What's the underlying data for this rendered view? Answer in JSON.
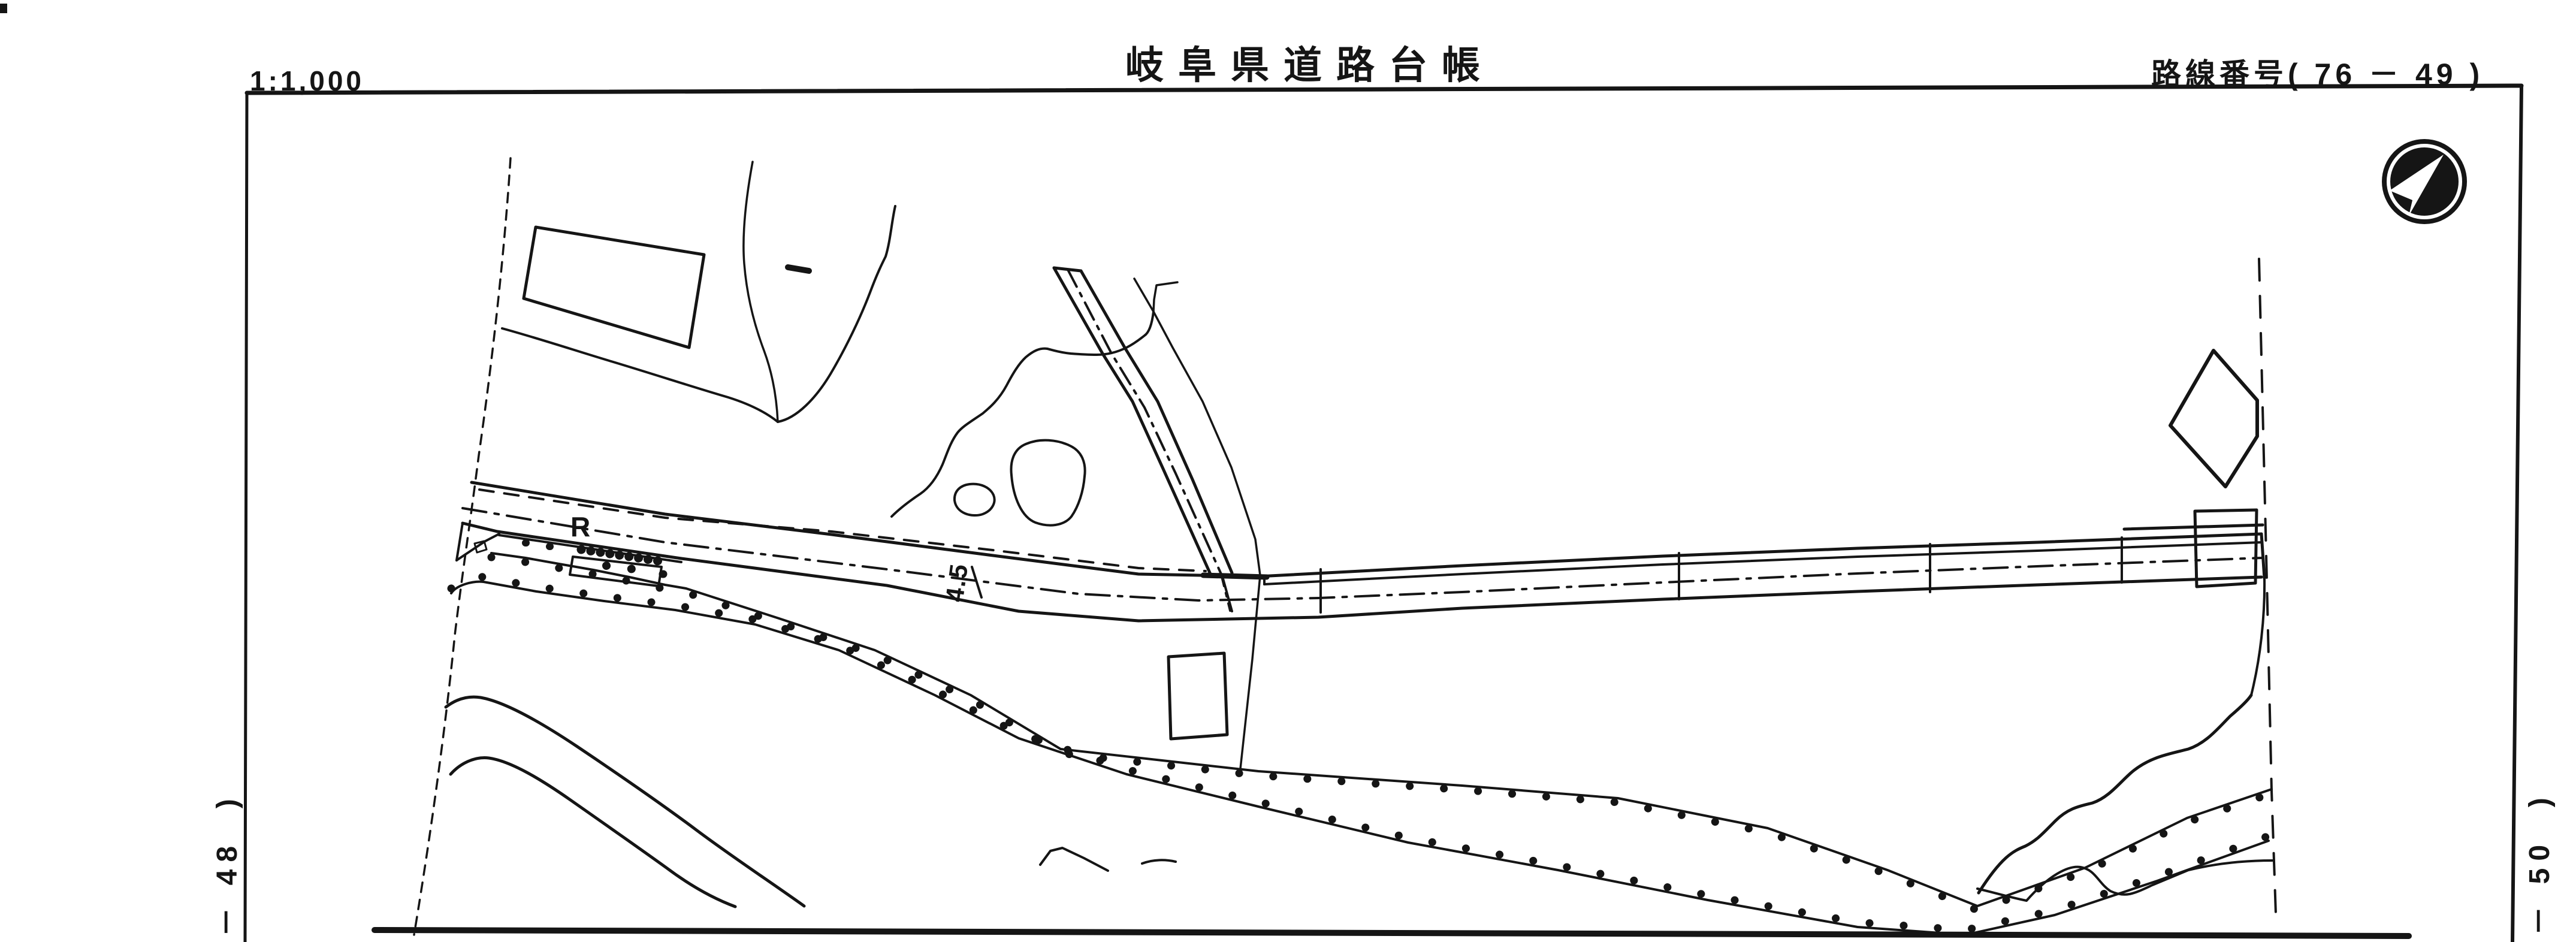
{
  "colors": {
    "ink": "#151515",
    "paper": "#ffffff"
  },
  "header": {
    "scale_label": "1:1,000",
    "title": "岐阜県道路台帳",
    "route_number_label": "路線番号( 76 － 49 )"
  },
  "map": {
    "labels": {
      "point_r": "R",
      "road_width": "4.5",
      "adjacent_sheet_left": "－ 48  )",
      "adjacent_sheet_right": "－ 50  )"
    },
    "icons": {
      "north": "north-arrow-icon"
    }
  }
}
